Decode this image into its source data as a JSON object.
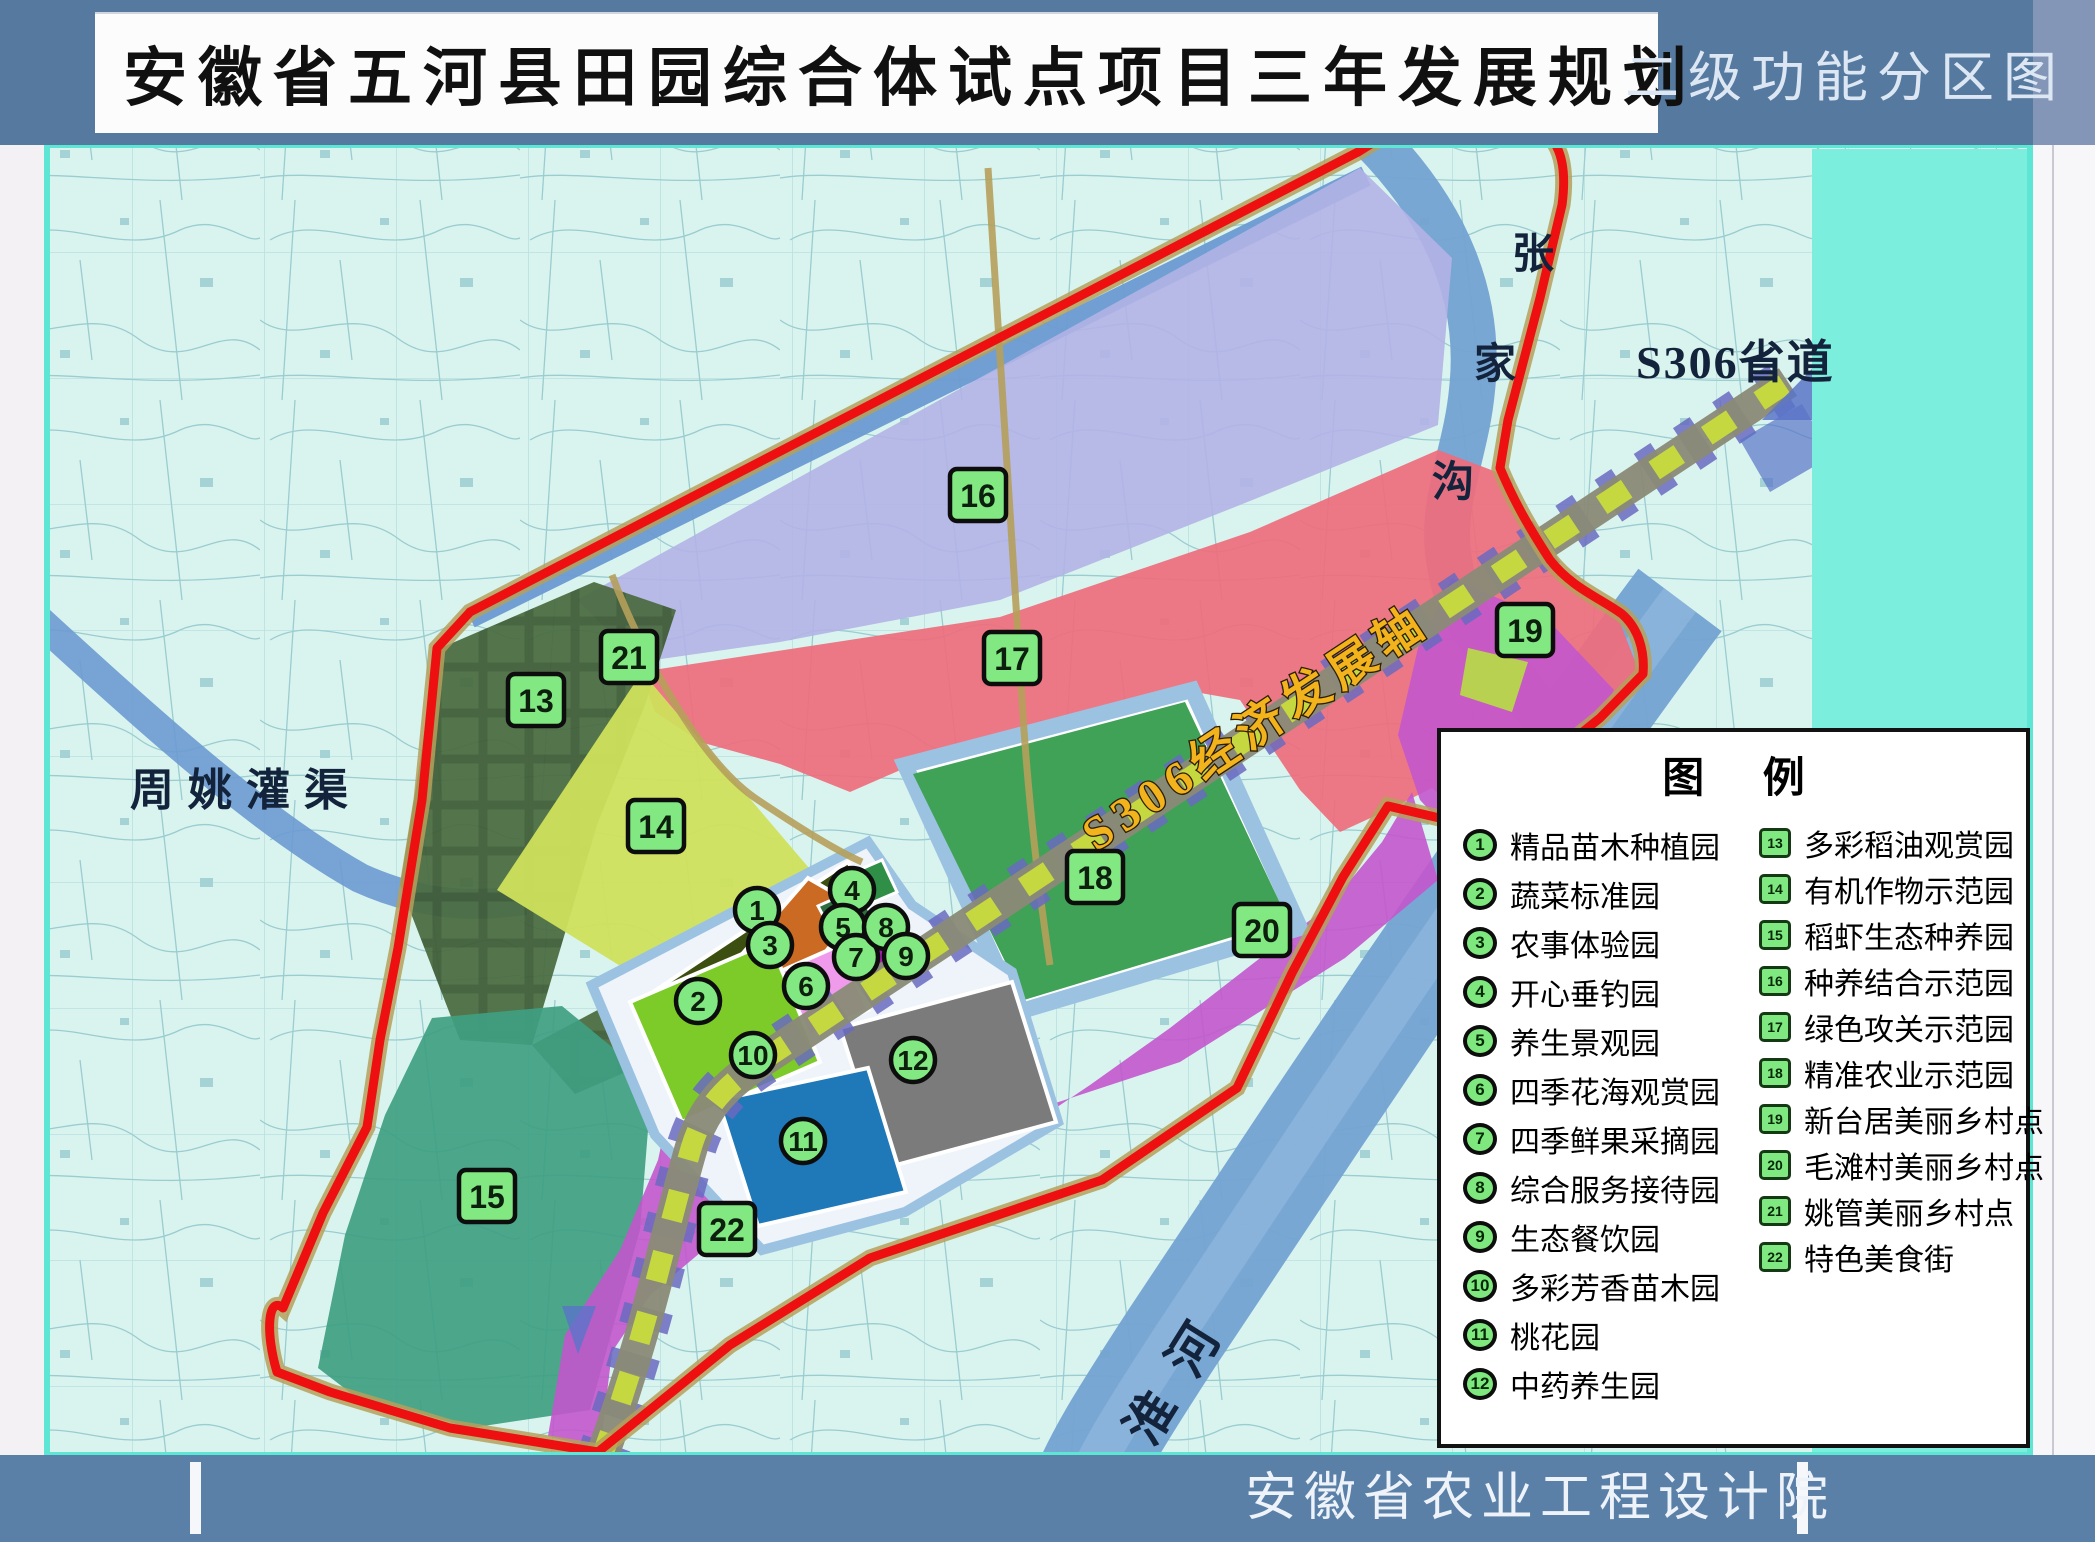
{
  "header": {
    "title": "安徽省五河县田园综合体试点项目三年发展规划",
    "corner_title": "二级功能分区图"
  },
  "footer": {
    "publisher": "安徽省农业工程设计院"
  },
  "legend": {
    "title": "图 例",
    "items": [
      {
        "n": "1",
        "label": "精品苗木种植园"
      },
      {
        "n": "2",
        "label": "蔬菜标准园"
      },
      {
        "n": "3",
        "label": "农事体验园"
      },
      {
        "n": "4",
        "label": "开心垂钓园"
      },
      {
        "n": "5",
        "label": "养生景观园"
      },
      {
        "n": "6",
        "label": "四季花海观赏园"
      },
      {
        "n": "7",
        "label": "四季鲜果采摘园"
      },
      {
        "n": "8",
        "label": "综合服务接待园"
      },
      {
        "n": "9",
        "label": "生态餐饮园"
      },
      {
        "n": "10",
        "label": "多彩芳香苗木园"
      },
      {
        "n": "11",
        "label": "桃花园"
      },
      {
        "n": "12",
        "label": "中药养生园"
      },
      {
        "n": "13",
        "label": "多彩稻油观赏园"
      },
      {
        "n": "14",
        "label": "有机作物示范园"
      },
      {
        "n": "15",
        "label": "稻虾生态种养园"
      },
      {
        "n": "16",
        "label": "种养结合示范园"
      },
      {
        "n": "17",
        "label": "绿色攻关示范园"
      },
      {
        "n": "18",
        "label": "精准农业示范园"
      },
      {
        "n": "19",
        "label": "新台居美丽乡村点"
      },
      {
        "n": "20",
        "label": "毛滩村美丽乡村点"
      },
      {
        "n": "21",
        "label": "姚管美丽乡村点"
      },
      {
        "n": "22",
        "label": "特色美食街"
      }
    ]
  },
  "map": {
    "labels": {
      "canal": "周姚灌渠",
      "zhang_chars": [
        "张",
        "家",
        "沟"
      ],
      "road": "S306省道",
      "axis": "S306经济发展轴",
      "river_huai": "淮河"
    },
    "badges": [
      {
        "n": "1",
        "x": 757,
        "y": 910,
        "shape": "circle"
      },
      {
        "n": "2",
        "x": 698,
        "y": 1001,
        "shape": "circle"
      },
      {
        "n": "3",
        "x": 770,
        "y": 945,
        "shape": "circle"
      },
      {
        "n": "4",
        "x": 852,
        "y": 890,
        "shape": "circle"
      },
      {
        "n": "5",
        "x": 843,
        "y": 927,
        "shape": "circle"
      },
      {
        "n": "6",
        "x": 806,
        "y": 986,
        "shape": "circle"
      },
      {
        "n": "7",
        "x": 856,
        "y": 957,
        "shape": "circle"
      },
      {
        "n": "8",
        "x": 886,
        "y": 927,
        "shape": "circle"
      },
      {
        "n": "9",
        "x": 906,
        "y": 956,
        "shape": "circle"
      },
      {
        "n": "10",
        "x": 753,
        "y": 1055,
        "shape": "circle"
      },
      {
        "n": "11",
        "x": 803,
        "y": 1141,
        "shape": "circle"
      },
      {
        "n": "12",
        "x": 913,
        "y": 1060,
        "shape": "circle"
      },
      {
        "n": "13",
        "x": 536,
        "y": 700,
        "shape": "square"
      },
      {
        "n": "14",
        "x": 656,
        "y": 826,
        "shape": "square"
      },
      {
        "n": "15",
        "x": 487,
        "y": 1196,
        "shape": "square"
      },
      {
        "n": "16",
        "x": 978,
        "y": 495,
        "shape": "square"
      },
      {
        "n": "17",
        "x": 1012,
        "y": 658,
        "shape": "square"
      },
      {
        "n": "18",
        "x": 1095,
        "y": 877,
        "shape": "square"
      },
      {
        "n": "19",
        "x": 1525,
        "y": 630,
        "shape": "square"
      },
      {
        "n": "20",
        "x": 1262,
        "y": 930,
        "shape": "square"
      },
      {
        "n": "21",
        "x": 629,
        "y": 657,
        "shape": "square"
      },
      {
        "n": "22",
        "x": 727,
        "y": 1229,
        "shape": "square"
      }
    ]
  },
  "colors": {
    "header_blue": "#56799f",
    "header_blue_light": "#8396b8",
    "footer_blue": "#5b80a8",
    "map_bg": "#d9f4ef",
    "cyan_block": "#7ceede",
    "map_border": "#5ee6d4",
    "red_boundary": "#ee1010",
    "road_tan": "#b5a05a",
    "river": "#74a2d2",
    "canal": "#6b9ad2",
    "axis_text": "#f3b31c",
    "badge_fill": "#82e882",
    "badge_border": "#0d0d0d",
    "zones": {
      "z13": "#4a6b40",
      "z13_line": "#3a5732",
      "z14": "#cfe05c",
      "z15": "#3f9f82",
      "z16": "#b3b2e6",
      "z17": "#ef6d7c",
      "z18": "#3fa257",
      "z19_patch": "#b8d84a",
      "z20": "#c356cc",
      "p1": "#3c4e10",
      "p2": "#7ccb28",
      "p3": "#cb6a22",
      "p4": "#2f8f46",
      "p5": "#2f6e40",
      "p6": "#f09aec",
      "p7": "#a21cac",
      "p11": "#1f78b8",
      "p12": "#7b7b7b",
      "road_axis_base": "#8a8a78",
      "road_axis_dash": "#c8dc3c",
      "road_axis_tie": "#6a6ac0",
      "frame_blue": "#9cc2e2",
      "arrow_blue": "#5a74c8"
    }
  }
}
